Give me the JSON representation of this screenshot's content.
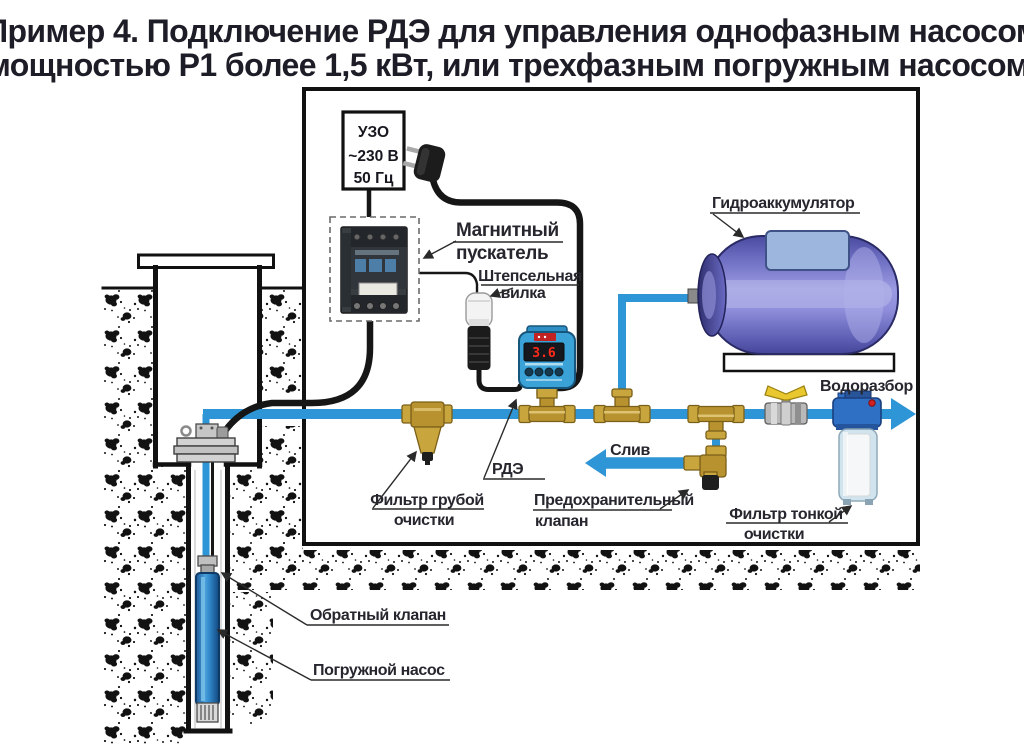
{
  "title": {
    "line1": "Пример 4. Подключение РДЭ для управления однофазным насосом",
    "line2": "мощностью Р1 более 1,5 кВт, или трехфазным погружным насосом."
  },
  "uzo_box": {
    "line1": "УЗО",
    "line2": "~230 В",
    "line3": "50 Гц"
  },
  "rde_device": {
    "display_value": "3.6"
  },
  "labels": {
    "magnetic_starter": {
      "line1": "Магнитный",
      "line2": "пускатель"
    },
    "plug": {
      "line1": "Штепсельная",
      "line2": "вилка"
    },
    "hydroaccumulator": "Гидроаккумулятор",
    "water_outlet": "Водоразбор",
    "drain": "Слив",
    "rde": "РДЭ",
    "coarse_filter": {
      "line1": "Фильтр грубой",
      "line2": "очистки"
    },
    "safety_valve": {
      "line1": "Предохранительный",
      "line2": "клапан"
    },
    "fine_filter": {
      "line1": "Фильтр тонкой",
      "line2": "очистки"
    },
    "check_valve": "Обратный клапан",
    "submersible_pump": "Погружной насос"
  },
  "colors": {
    "pipe_blue": "#2e96d6",
    "cable_black": "#161616",
    "brass": "#c9a53e",
    "tank_blue": "#9a9ae2",
    "rde_blue": "#3ba2d8",
    "display_red": "#ff2a1a",
    "text_dark": "#26262e"
  }
}
